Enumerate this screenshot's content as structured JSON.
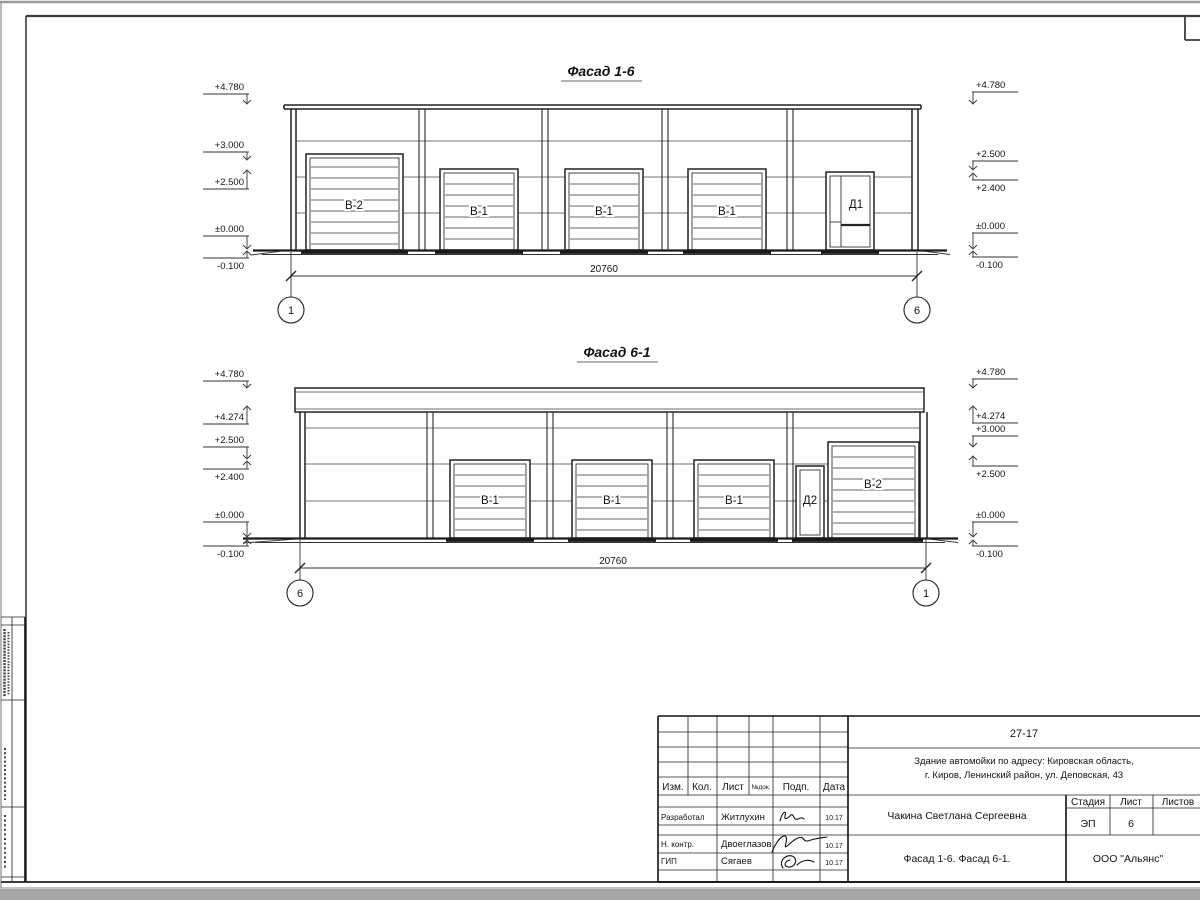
{
  "facades": {
    "top": {
      "title": "Фасад 1-6",
      "dimension": "20760",
      "axis_left": "1",
      "axis_right": "6",
      "marks_left": [
        "+4.780",
        "+3.000",
        "+2.500",
        "±0.000",
        "-0.100"
      ],
      "marks_right": [
        "+4.780",
        "+2.500",
        "+2.400",
        "±0.000",
        "-0.100"
      ],
      "door_labels": {
        "b2": "В-2",
        "b1a": "В-1",
        "b1b": "В-1",
        "b1c": "В-1",
        "d": "Д1"
      }
    },
    "bottom": {
      "title": "Фасад 6-1",
      "dimension": "20760",
      "axis_left": "6",
      "axis_right": "1",
      "marks_left": [
        "+4.780",
        "+4.274",
        "+2.500",
        "+2.400",
        "±0.000",
        "-0.100"
      ],
      "marks_right": [
        "+4.780",
        "+4.274",
        "+3.000",
        "+2.500",
        "±0.000",
        "-0.100"
      ],
      "door_labels": {
        "b1a": "В-1",
        "b1b": "В-1",
        "b1c": "В-1",
        "d": "Д2",
        "b2": "В-2"
      }
    }
  },
  "title_block": {
    "doc_number": "27-17",
    "object_line1": "Здание автомойки по адресу: Кировская область,",
    "object_line2": "г. Киров, Ленинский район, ул. Деповская, 43",
    "rev_headers": [
      "Изм.",
      "Кол.",
      "Лист",
      "№док.",
      "Подп.",
      "Дата"
    ],
    "signers": [
      {
        "role": "Разработал",
        "name": "Житлухин",
        "date": "10.17"
      },
      {
        "role": "Н. контр.",
        "name": "Двоеглазов",
        "date": "10.17"
      },
      {
        "role": "ГИП",
        "name": "Сягаев",
        "date": "10.17"
      }
    ],
    "customer": "Чакина Светлана Сергеевна",
    "stage_header": "Стадия",
    "sheet_header": "Лист",
    "total_header": "Листов",
    "stage": "ЭП",
    "sheet_number": "6",
    "total_sheets": "",
    "drawing_title": "Фасад 1-6. Фасад 6-1.",
    "company": "ООО \"Альянс\""
  }
}
